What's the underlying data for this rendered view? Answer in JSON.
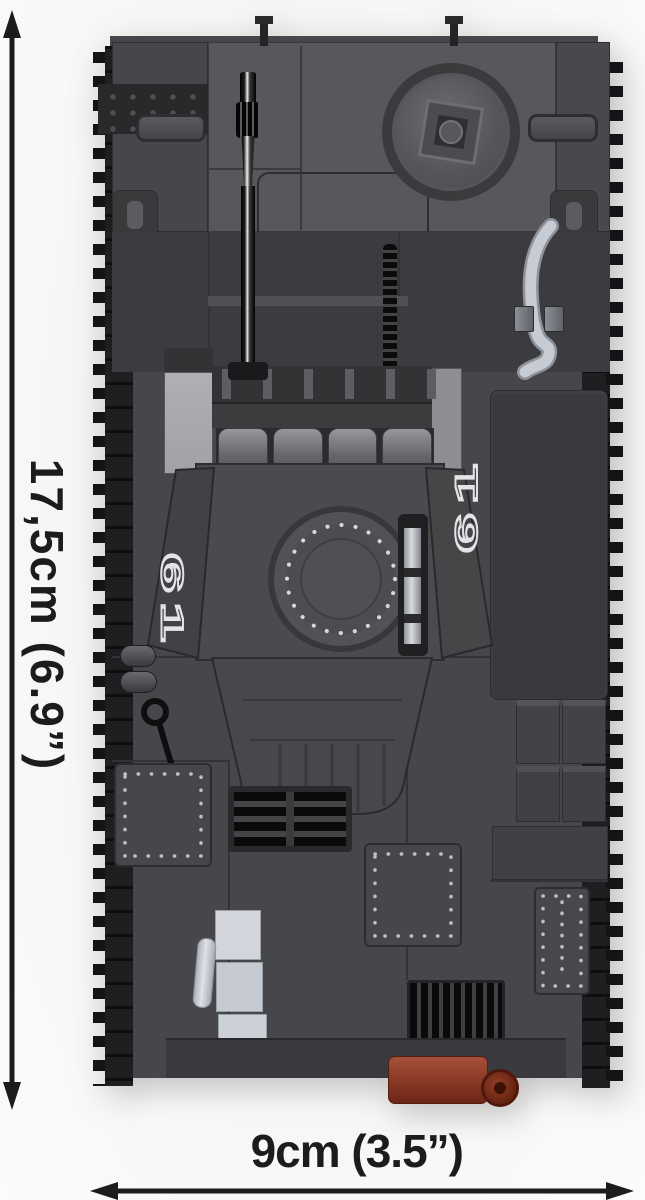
{
  "dimensions": {
    "height_label": "17,5cm (6.9”)",
    "width_label": "9cm (3.5”)"
  },
  "tank": {
    "turret_marking_left": "61",
    "turret_marking_right": "61"
  },
  "colors": {
    "background": "#f6f6f5",
    "annotation_black": "#1c1c1c",
    "brick_dark": "#3c3c40",
    "brick_mid": "#47474b",
    "brick_light": "#58585c",
    "panel_silver": "#a2a2a6",
    "track_black": "#1f1f22",
    "tool_silver": "#c7cbd3",
    "pale_gray": "#ccd0d7",
    "rust_brown": "#8a3a27",
    "marking_white": "#e4e4e7"
  }
}
